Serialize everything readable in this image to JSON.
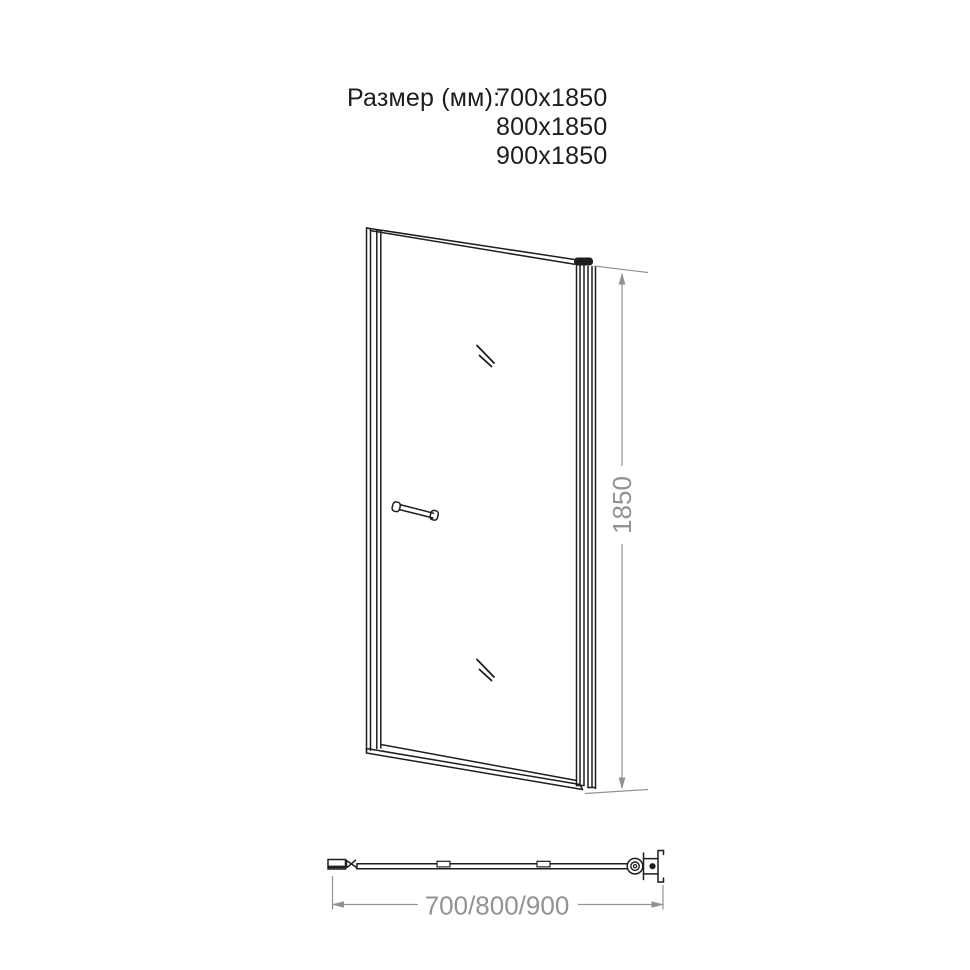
{
  "size_block": {
    "label": "Размер (мм):",
    "options": [
      "700x1850",
      "800x1850",
      "900x1850"
    ]
  },
  "diagram": {
    "front_view": {
      "height_label": "1850"
    },
    "plan_view": {
      "width_label": "700/800/900"
    }
  },
  "colors": {
    "background": "#ffffff",
    "drawing_line": "#1e1e1e",
    "dimension": "#929292",
    "text": "#1d1d1d"
  }
}
